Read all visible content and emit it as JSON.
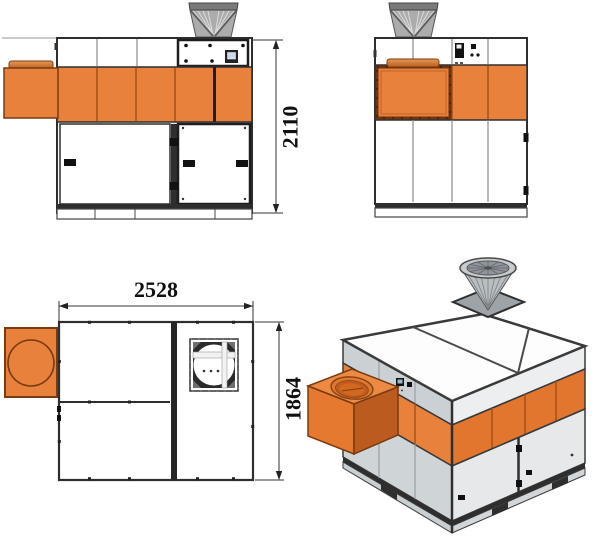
{
  "drawing": {
    "title": "four-view-technical-drawing",
    "dimensions": {
      "front_height": "2110",
      "plan_width": "2528",
      "plan_depth": "1864"
    }
  },
  "colors": {
    "orange": "#E8813C",
    "orange_shadow": "#C05A20",
    "orange_light": "#EC8A44",
    "flange_dark": "#7A3B10",
    "cowl_gray": "#ACACAC",
    "panel_gray": "#CBD0D4",
    "outline": "#2E2E2E",
    "panel_white": "#FFFFFF"
  }
}
